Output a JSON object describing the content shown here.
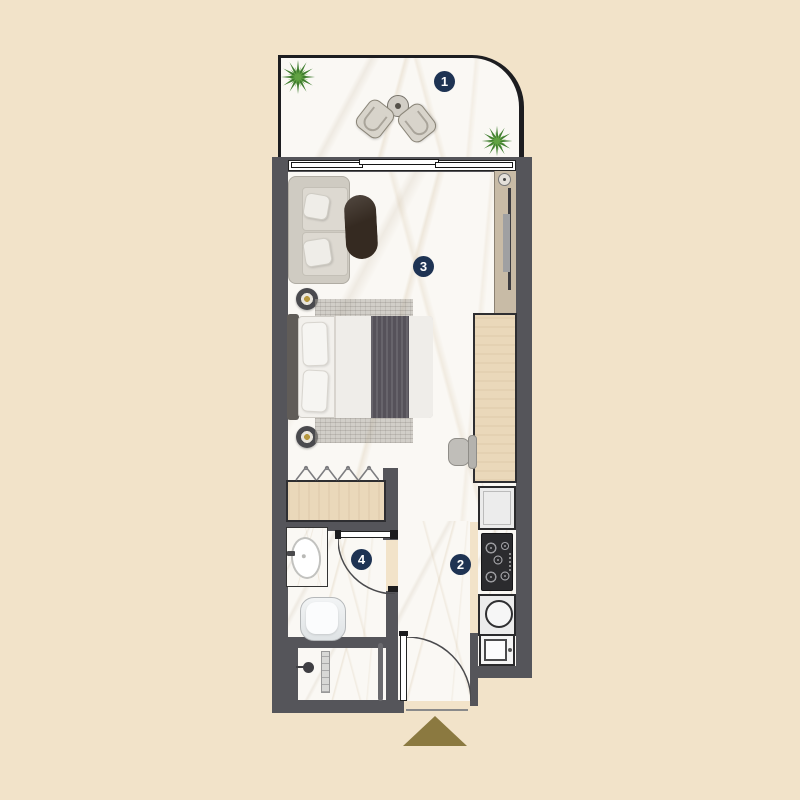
{
  "floor_plan": {
    "room_labels": [
      {
        "number": "1",
        "room": "balcony"
      },
      {
        "number": "2",
        "room": "kitchen"
      },
      {
        "number": "3",
        "room": "living-sleeping-area"
      },
      {
        "number": "4",
        "room": "bathroom"
      }
    ],
    "entrance_marker": "triangle-up"
  },
  "icons": {
    "plant": "starburst-plant-icon",
    "hangers": "wardrobe-hanger-icon",
    "door_swing": "quarter-arc-door-icon",
    "shower": "shower-head-icon"
  },
  "colors": {
    "background": "#f2e3c9",
    "wall": "#55555a",
    "wall_outline": "#2d2d31",
    "floor": "#faf8f4",
    "wood_light": "#ead8ba",
    "greige_panel": "#c8bba6",
    "label_navy": "#1e3353",
    "label_text": "#ffffff",
    "entrance_gold": "#8b7940",
    "plant_green_dark": "#3f7d2e",
    "plant_green_light": "#61a243",
    "table_dark": "#352a21",
    "fabric_light": "#dcd8d0",
    "bed_white": "#f2f0ec",
    "throw_dark": "#56525a",
    "rug_gray": "#b7b2ac",
    "appliance_line": "#2a2a2c"
  }
}
